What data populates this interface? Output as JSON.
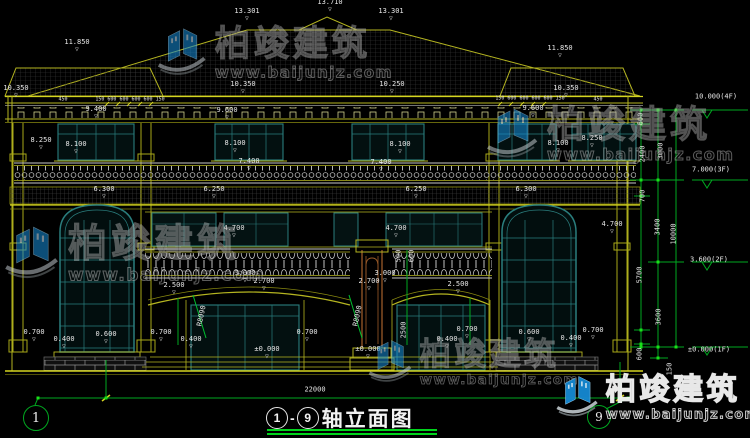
{
  "colors": {
    "line_yellow": "#b5b520",
    "line_yellow_bright": "#d6d620",
    "dim_green": "#00a820",
    "dim_green_bright": "#19e019",
    "window_teal": "#2a7d7d",
    "column_brown": "#9a5a28",
    "baluster_gray": "#c2c2c2",
    "label_white": "#e6e6e6",
    "title_underline": "#00d41c",
    "watermark_logo_blue": "#1587cf",
    "background": "#000000"
  },
  "title": {
    "axis_start": "1",
    "dash": "-",
    "axis_end": "9",
    "name": "轴立面图"
  },
  "axis_circles": [
    {
      "label": "1",
      "x": 35,
      "y": 417,
      "r": 12
    },
    {
      "label": "9",
      "x": 598,
      "y": 416,
      "r": 11
    }
  ],
  "watermark": {
    "brand": "柏竣建筑",
    "url": "www.baijunjz.com",
    "instances": [
      {
        "x": 155,
        "y": 26,
        "s": 0.95,
        "strong": false
      },
      {
        "x": 484,
        "y": 106,
        "s": 1.0,
        "strong": false
      },
      {
        "x": 2,
        "y": 224,
        "s": 1.05,
        "strong": false
      },
      {
        "x": 366,
        "y": 338,
        "s": 0.85,
        "strong": false
      },
      {
        "x": 554,
        "y": 374,
        "s": 0.82,
        "strong": true
      }
    ]
  },
  "dimension_labels": [
    {
      "t": "13.710",
      "x": 330,
      "y": 6,
      "m": 1
    },
    {
      "t": "13.301",
      "x": 247,
      "y": 15,
      "m": 1
    },
    {
      "t": "13.301",
      "x": 391,
      "y": 15,
      "m": 1
    },
    {
      "t": "11.850",
      "x": 77,
      "y": 46,
      "m": 1
    },
    {
      "t": "11.850",
      "x": 560,
      "y": 52,
      "m": 1
    },
    {
      "t": "10.350",
      "x": 16,
      "y": 92,
      "m": 1
    },
    {
      "t": "10.350",
      "x": 243,
      "y": 88,
      "m": 1
    },
    {
      "t": "10.250",
      "x": 392,
      "y": 88,
      "m": 1
    },
    {
      "t": "10.350",
      "x": 566,
      "y": 92,
      "m": 1
    },
    {
      "t": "450",
      "x": 63,
      "y": 100,
      "s": 5
    },
    {
      "t": "150 600 600 600 600 150",
      "x": 130,
      "y": 100,
      "s": 5
    },
    {
      "t": "150 600 600 600 600 150",
      "x": 530,
      "y": 99,
      "s": 5
    },
    {
      "t": "450",
      "x": 598,
      "y": 100,
      "s": 5
    },
    {
      "t": "9.400",
      "x": 96,
      "y": 113,
      "m": 1
    },
    {
      "t": "9.600",
      "x": 227,
      "y": 114,
      "m": 1
    },
    {
      "t": "9.600",
      "x": 533,
      "y": 112,
      "m": 1
    },
    {
      "t": "8.250",
      "x": 41,
      "y": 144,
      "m": 1
    },
    {
      "t": "8.100",
      "x": 76,
      "y": 148,
      "m": 1
    },
    {
      "t": "8.100",
      "x": 235,
      "y": 147,
      "m": 1
    },
    {
      "t": "8.100",
      "x": 400,
      "y": 148,
      "m": 1
    },
    {
      "t": "8.100",
      "x": 558,
      "y": 147,
      "m": 1
    },
    {
      "t": "8.250",
      "x": 592,
      "y": 142,
      "m": 1
    },
    {
      "t": "7.400",
      "x": 249,
      "y": 165,
      "m": 1
    },
    {
      "t": "7.400",
      "x": 381,
      "y": 166,
      "m": 1
    },
    {
      "t": "6.300",
      "x": 104,
      "y": 193,
      "m": 1
    },
    {
      "t": "6.250",
      "x": 214,
      "y": 193,
      "m": 1
    },
    {
      "t": "6.250",
      "x": 416,
      "y": 193,
      "m": 1
    },
    {
      "t": "6.300",
      "x": 526,
      "y": 193,
      "m": 1
    },
    {
      "t": "4.700",
      "x": 234,
      "y": 232,
      "m": 1
    },
    {
      "t": "4.700",
      "x": 396,
      "y": 232,
      "m": 1
    },
    {
      "t": "4.700",
      "x": 612,
      "y": 228,
      "m": 1
    },
    {
      "t": "3.000",
      "x": 245,
      "y": 277,
      "m": 1
    },
    {
      "t": "3.000",
      "x": 385,
      "y": 277,
      "m": 1
    },
    {
      "t": "2.700",
      "x": 264,
      "y": 285,
      "m": 1
    },
    {
      "t": "2.700",
      "x": 369,
      "y": 285,
      "m": 1
    },
    {
      "t": "2.500",
      "x": 174,
      "y": 289,
      "m": 1
    },
    {
      "t": "2.500",
      "x": 458,
      "y": 288,
      "m": 1
    },
    {
      "t": "R8090",
      "x": 202,
      "y": 316,
      "r": -78
    },
    {
      "t": "R8090",
      "x": 358,
      "y": 316,
      "r": -78
    },
    {
      "t": "2500",
      "x": 404,
      "y": 330,
      "r": -90
    },
    {
      "t": "600",
      "x": 412,
      "y": 256,
      "r": -90
    },
    {
      "t": "500",
      "x": 399,
      "y": 256,
      "r": -90
    },
    {
      "t": "0.700",
      "x": 34,
      "y": 336,
      "m": 1
    },
    {
      "t": "0.400",
      "x": 64,
      "y": 343,
      "m": 1
    },
    {
      "t": "0.600",
      "x": 106,
      "y": 338,
      "m": 1
    },
    {
      "t": "0.700",
      "x": 161,
      "y": 336,
      "m": 1
    },
    {
      "t": "0.400",
      "x": 191,
      "y": 343,
      "m": 1
    },
    {
      "t": "0.700",
      "x": 307,
      "y": 336,
      "m": 1
    },
    {
      "t": "±0.000",
      "x": 267,
      "y": 353,
      "m": 1
    },
    {
      "t": "±0.000",
      "x": 368,
      "y": 353,
      "m": 1
    },
    {
      "t": "0.400",
      "x": 447,
      "y": 343,
      "m": 1
    },
    {
      "t": "0.700",
      "x": 467,
      "y": 333,
      "m": 1
    },
    {
      "t": "0.600",
      "x": 529,
      "y": 336,
      "m": 1
    },
    {
      "t": "0.400",
      "x": 571,
      "y": 342,
      "m": 1
    },
    {
      "t": "0.700",
      "x": 593,
      "y": 334,
      "m": 1
    },
    {
      "t": "22000",
      "x": 315,
      "y": 390
    },
    {
      "t": "10.000(4F)",
      "x": 716,
      "y": 97
    },
    {
      "t": "7.000(3F)",
      "x": 711,
      "y": 170
    },
    {
      "t": "3.600(2F)",
      "x": 709,
      "y": 260
    },
    {
      "t": "±0.000(1F)",
      "x": 709,
      "y": 350
    },
    {
      "t": "600",
      "x": 641,
      "y": 119,
      "r": -90
    },
    {
      "t": "2400",
      "x": 643,
      "y": 154,
      "r": -90
    },
    {
      "t": "3000",
      "x": 661,
      "y": 151,
      "r": -90
    },
    {
      "t": "700",
      "x": 643,
      "y": 196,
      "r": -90
    },
    {
      "t": "3400",
      "x": 658,
      "y": 227,
      "r": -90
    },
    {
      "t": "10000",
      "x": 674,
      "y": 234,
      "r": -90
    },
    {
      "t": "5700",
      "x": 640,
      "y": 275,
      "r": -90
    },
    {
      "t": "3600",
      "x": 659,
      "y": 317,
      "r": -90
    },
    {
      "t": "600",
      "x": 640,
      "y": 354,
      "r": -90
    },
    {
      "t": "150",
      "x": 670,
      "y": 369,
      "r": -90
    }
  ]
}
